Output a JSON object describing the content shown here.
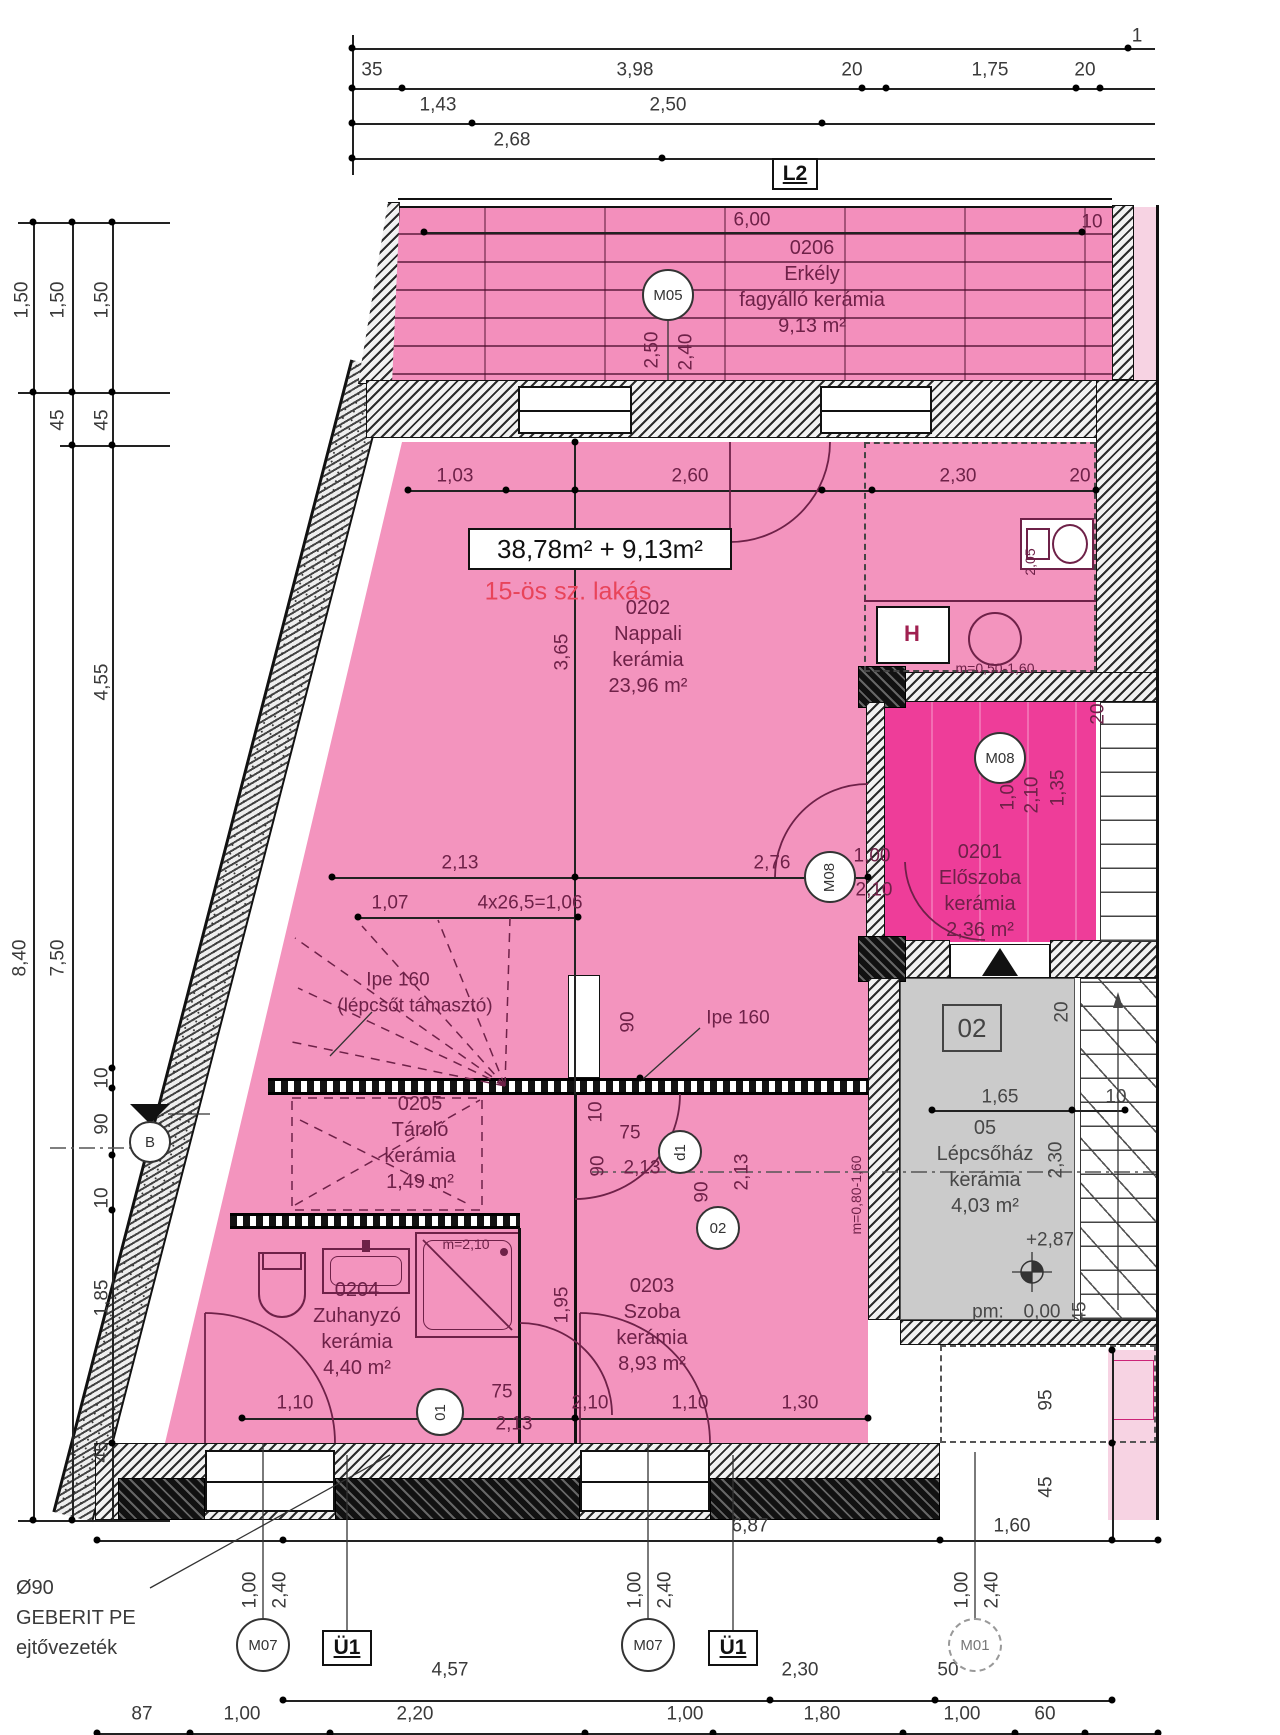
{
  "plan_meta": {
    "unit_area_label": "38,78m² + 9,13m²",
    "unit_name": "15-ös sz. lakás",
    "colors": {
      "apartment_pink": "#F394BE",
      "entry_magenta": "#EE3D99",
      "stairwell_grey": "#CBCBCB",
      "adjacent_pink": "#F7D3E3",
      "accent_red": "#E8445A",
      "dim_text": "#3A3A3A",
      "interior_text": "#6E2148"
    }
  },
  "rooms": [
    {
      "number": "0206",
      "name": "Erkély",
      "material": "fagyálló kerámia",
      "area": "9,13 m²",
      "x": 812,
      "y": 248,
      "cls": "pink"
    },
    {
      "number": "0202",
      "name": "Nappali",
      "material": "kerámia",
      "area": "23,96 m²",
      "x": 648,
      "y": 608,
      "cls": "pink"
    },
    {
      "number": "0201",
      "name": "Előszoba",
      "material": "kerámia",
      "area": "2,36 m²",
      "x": 980,
      "y": 852,
      "cls": "pink"
    },
    {
      "number": "0205",
      "name": "Tároló",
      "material": "kerámia",
      "area": "1,49 m²",
      "x": 420,
      "y": 1104,
      "cls": "pink"
    },
    {
      "number": "0203",
      "name": "Szoba",
      "material": "kerámia",
      "area": "8,93 m²",
      "x": 652,
      "y": 1286,
      "cls": "pink"
    },
    {
      "number": "0204",
      "name": "Zuhanyzó",
      "material": "kerámia",
      "area": "4,40 m²",
      "x": 357,
      "y": 1290,
      "cls": "pink"
    },
    {
      "number": "05",
      "name": "Lépcsőház",
      "material": "kerámia",
      "area": "4,03 m²",
      "x": 985,
      "y": 1128,
      "cls": "grey"
    }
  ],
  "boxes": [
    {
      "t": "L2",
      "x": 772,
      "y": 158,
      "w": 46,
      "h": 32,
      "cls": ""
    },
    {
      "t": "Ü1",
      "x": 322,
      "y": 1630,
      "w": 50,
      "h": 36,
      "cls": ""
    },
    {
      "t": "Ü1",
      "x": 708,
      "y": 1630,
      "w": 50,
      "h": 36,
      "cls": ""
    },
    {
      "t": "02",
      "x": 942,
      "y": 1004,
      "w": 60,
      "h": 48,
      "cls": "ref2"
    },
    {
      "t": "38,78m² + 9,13m²",
      "x": 468,
      "y": 528,
      "w": 264,
      "h": 42,
      "cls": "area"
    }
  ],
  "markers": [
    {
      "t": "M05",
      "x": 668,
      "y": 295,
      "r": 26
    },
    {
      "t": "M08",
      "x": 830,
      "y": 877,
      "r": 26,
      "rot": 1
    },
    {
      "t": "M08",
      "x": 1000,
      "y": 758,
      "r": 26
    },
    {
      "t": "01",
      "x": 440,
      "y": 1412,
      "r": 24,
      "rot": 1
    },
    {
      "t": "02",
      "x": 718,
      "y": 1228,
      "r": 22
    },
    {
      "t": "d1",
      "x": 680,
      "y": 1152,
      "r": 22,
      "rot": 1
    },
    {
      "t": "M07",
      "x": 263,
      "y": 1645,
      "r": 27
    },
    {
      "t": "M07",
      "x": 648,
      "y": 1645,
      "r": 27
    },
    {
      "t": "M01",
      "x": 975,
      "y": 1645,
      "r": 27,
      "dash": 1
    },
    {
      "t": "B",
      "x": 150,
      "y": 1142,
      "r": 21
    }
  ],
  "labels": [
    {
      "t": "1",
      "x": 1137,
      "y": 36,
      "c": "d"
    },
    {
      "t": "35",
      "x": 372,
      "y": 70,
      "c": "d"
    },
    {
      "t": "3,98",
      "x": 635,
      "y": 70,
      "c": "d"
    },
    {
      "t": "20",
      "x": 852,
      "y": 70,
      "c": "d"
    },
    {
      "t": "1,75",
      "x": 990,
      "y": 70,
      "c": "d"
    },
    {
      "t": "20",
      "x": 1085,
      "y": 70,
      "c": "d"
    },
    {
      "t": "1,43",
      "x": 438,
      "y": 105,
      "c": "d"
    },
    {
      "t": "2,50",
      "x": 668,
      "y": 105,
      "c": "d"
    },
    {
      "t": "2,68",
      "x": 512,
      "y": 140,
      "c": "d"
    },
    {
      "t": "6,00",
      "x": 752,
      "y": 220,
      "c": "p"
    },
    {
      "t": "10",
      "x": 1092,
      "y": 222,
      "c": "p"
    },
    {
      "t": "2,50",
      "x": 652,
      "y": 350,
      "c": "p",
      "r": 1
    },
    {
      "t": "2,40",
      "x": 686,
      "y": 352,
      "c": "p",
      "r": 1
    },
    {
      "t": "1,03",
      "x": 455,
      "y": 476,
      "c": "p"
    },
    {
      "t": "2,60",
      "x": 690,
      "y": 476,
      "c": "p"
    },
    {
      "t": "2,30",
      "x": 958,
      "y": 476,
      "c": "p"
    },
    {
      "t": "20",
      "x": 1080,
      "y": 476,
      "c": "p"
    },
    {
      "t": "3,65",
      "x": 562,
      "y": 652,
      "c": "p",
      "r": 1
    },
    {
      "t": "H",
      "x": 912,
      "y": 634,
      "c": "ph"
    },
    {
      "t": "m=0,50-1,60",
      "x": 995,
      "y": 668,
      "c": "s"
    },
    {
      "t": "2,05",
      "x": 1030,
      "y": 562,
      "c": "s",
      "r": 1
    },
    {
      "t": "2,13",
      "x": 460,
      "y": 863,
      "c": "p"
    },
    {
      "t": "2,76",
      "x": 772,
      "y": 863,
      "c": "p"
    },
    {
      "t": "1,00",
      "x": 872,
      "y": 856,
      "c": "p"
    },
    {
      "t": "2,10",
      "x": 874,
      "y": 890,
      "c": "p"
    },
    {
      "t": "1,07",
      "x": 390,
      "y": 903,
      "c": "p"
    },
    {
      "t": "4x26,5=1,06",
      "x": 530,
      "y": 903,
      "c": "p"
    },
    {
      "t": "Ipe 160",
      "x": 398,
      "y": 980,
      "c": "p"
    },
    {
      "t": "(lépcsőt támasztó)",
      "x": 415,
      "y": 1006,
      "c": "p"
    },
    {
      "t": "Ipe 160",
      "x": 738,
      "y": 1018,
      "c": "p"
    },
    {
      "t": "90",
      "x": 628,
      "y": 1022,
      "c": "p",
      "r": 1
    },
    {
      "t": "10",
      "x": 596,
      "y": 1112,
      "c": "p",
      "r": 1
    },
    {
      "t": "75",
      "x": 630,
      "y": 1133,
      "c": "p"
    },
    {
      "t": "90",
      "x": 598,
      "y": 1166,
      "c": "p",
      "r": 1
    },
    {
      "t": "2,13",
      "x": 642,
      "y": 1168,
      "c": "p"
    },
    {
      "t": "90",
      "x": 702,
      "y": 1192,
      "c": "p",
      "r": 1
    },
    {
      "t": "2,13",
      "x": 742,
      "y": 1172,
      "c": "p",
      "r": 1
    },
    {
      "t": "1,95",
      "x": 562,
      "y": 1305,
      "c": "p",
      "r": 1
    },
    {
      "t": "m=0,80-1,60",
      "x": 856,
      "y": 1195,
      "c": "s",
      "r": 1
    },
    {
      "t": "m=2,10",
      "x": 466,
      "y": 1244,
      "c": "s"
    },
    {
      "t": "1,10",
      "x": 295,
      "y": 1403,
      "c": "p"
    },
    {
      "t": "75",
      "x": 502,
      "y": 1392,
      "c": "p"
    },
    {
      "t": "2,13",
      "x": 514,
      "y": 1424,
      "c": "p"
    },
    {
      "t": "2,10",
      "x": 590,
      "y": 1403,
      "c": "p"
    },
    {
      "t": "1,10",
      "x": 690,
      "y": 1403,
      "c": "p"
    },
    {
      "t": "1,30",
      "x": 800,
      "y": 1403,
      "c": "p"
    },
    {
      "t": "1,00",
      "x": 1008,
      "y": 792,
      "c": "p",
      "r": 1
    },
    {
      "t": "2,10",
      "x": 1032,
      "y": 795,
      "c": "p",
      "r": 1
    },
    {
      "t": "1,35",
      "x": 1058,
      "y": 788,
      "c": "p",
      "r": 1
    },
    {
      "t": "20",
      "x": 1098,
      "y": 714,
      "c": "p",
      "r": 1
    },
    {
      "t": "20",
      "x": 1062,
      "y": 1012,
      "c": "g",
      "r": 1
    },
    {
      "t": "1,65",
      "x": 1000,
      "y": 1097,
      "c": "g"
    },
    {
      "t": "10",
      "x": 1116,
      "y": 1097,
      "c": "g"
    },
    {
      "t": "2,30",
      "x": 1056,
      "y": 1160,
      "c": "g",
      "r": 1
    },
    {
      "t": "+2,87",
      "x": 1050,
      "y": 1240,
      "c": "g"
    },
    {
      "t": "pm:",
      "x": 988,
      "y": 1312,
      "c": "g"
    },
    {
      "t": "0,00",
      "x": 1042,
      "y": 1312,
      "c": "g"
    },
    {
      "t": "45",
      "x": 1080,
      "y": 1312,
      "c": "g",
      "r": 1
    },
    {
      "t": "95",
      "x": 1046,
      "y": 1400,
      "c": "d",
      "r": 1
    },
    {
      "t": "45",
      "x": 1046,
      "y": 1487,
      "c": "d",
      "r": 1
    },
    {
      "t": "6,87",
      "x": 750,
      "y": 1526,
      "c": "d"
    },
    {
      "t": "1,60",
      "x": 1012,
      "y": 1526,
      "c": "d"
    },
    {
      "t": "1,50",
      "x": 22,
      "y": 300,
      "c": "d",
      "r": 1
    },
    {
      "t": "1,50",
      "x": 58,
      "y": 300,
      "c": "d",
      "r": 1
    },
    {
      "t": "1,50",
      "x": 102,
      "y": 300,
      "c": "d",
      "r": 1
    },
    {
      "t": "45",
      "x": 58,
      "y": 420,
      "c": "d",
      "r": 1
    },
    {
      "t": "45",
      "x": 102,
      "y": 420,
      "c": "d",
      "r": 1
    },
    {
      "t": "4,55",
      "x": 102,
      "y": 682,
      "c": "d",
      "r": 1
    },
    {
      "t": "8,40",
      "x": 20,
      "y": 958,
      "c": "d",
      "r": 1
    },
    {
      "t": "7,50",
      "x": 58,
      "y": 958,
      "c": "d",
      "r": 1
    },
    {
      "t": "10",
      "x": 102,
      "y": 1078,
      "c": "d",
      "r": 1
    },
    {
      "t": "90",
      "x": 102,
      "y": 1124,
      "c": "d",
      "r": 1
    },
    {
      "t": "10",
      "x": 102,
      "y": 1198,
      "c": "d",
      "r": 1
    },
    {
      "t": "1,85",
      "x": 102,
      "y": 1298,
      "c": "d",
      "r": 1
    },
    {
      "t": "45",
      "x": 102,
      "y": 1452,
      "c": "d",
      "r": 1
    },
    {
      "t": "1,00",
      "x": 250,
      "y": 1590,
      "c": "d",
      "r": 1
    },
    {
      "t": "2,40",
      "x": 280,
      "y": 1590,
      "c": "d",
      "r": 1
    },
    {
      "t": "1,00",
      "x": 635,
      "y": 1590,
      "c": "d",
      "r": 1
    },
    {
      "t": "2,40",
      "x": 665,
      "y": 1590,
      "c": "d",
      "r": 1
    },
    {
      "t": "1,00",
      "x": 962,
      "y": 1590,
      "c": "d",
      "r": 1
    },
    {
      "t": "2,40",
      "x": 992,
      "y": 1590,
      "c": "d",
      "r": 1
    },
    {
      "t": "4,57",
      "x": 450,
      "y": 1670,
      "c": "d"
    },
    {
      "t": "2,30",
      "x": 800,
      "y": 1670,
      "c": "d"
    },
    {
      "t": "50",
      "x": 948,
      "y": 1670,
      "c": "d"
    },
    {
      "t": "87",
      "x": 142,
      "y": 1714,
      "c": "d"
    },
    {
      "t": "1,00",
      "x": 242,
      "y": 1714,
      "c": "d"
    },
    {
      "t": "2,20",
      "x": 415,
      "y": 1714,
      "c": "d"
    },
    {
      "t": "1,00",
      "x": 685,
      "y": 1714,
      "c": "d"
    },
    {
      "t": "1,80",
      "x": 822,
      "y": 1714,
      "c": "d"
    },
    {
      "t": "1,00",
      "x": 962,
      "y": 1714,
      "c": "d"
    },
    {
      "t": "60",
      "x": 1045,
      "y": 1714,
      "c": "d"
    },
    {
      "t": "Ø90",
      "x": 16,
      "y": 1588,
      "c": "dl"
    },
    {
      "t": "GEBERIT PE",
      "x": 16,
      "y": 1618,
      "c": "dl"
    },
    {
      "t": "ejtővezeték",
      "x": 16,
      "y": 1648,
      "c": "dl"
    },
    {
      "t": "15-ös sz. lakás",
      "x": 568,
      "y": 592,
      "c": "r"
    }
  ],
  "dots": [
    [
      352,
      48
    ],
    [
      1128,
      48
    ],
    [
      352,
      88
    ],
    [
      402,
      88
    ],
    [
      862,
      88
    ],
    [
      886,
      88
    ],
    [
      1076,
      88
    ],
    [
      1100,
      88
    ],
    [
      352,
      123
    ],
    [
      472,
      123
    ],
    [
      822,
      123
    ],
    [
      352,
      158
    ],
    [
      662,
      158
    ],
    [
      424,
      232
    ],
    [
      1082,
      232
    ],
    [
      408,
      490
    ],
    [
      506,
      490
    ],
    [
      575,
      490
    ],
    [
      822,
      490
    ],
    [
      872,
      490
    ],
    [
      1096,
      490
    ],
    [
      332,
      877
    ],
    [
      575,
      877
    ],
    [
      868,
      877
    ],
    [
      358,
      917
    ],
    [
      578,
      917
    ],
    [
      932,
      1110
    ],
    [
      1072,
      1110
    ],
    [
      1125,
      1110
    ],
    [
      242,
      1418
    ],
    [
      575,
      1418
    ],
    [
      868,
      1418
    ],
    [
      97,
      1540
    ],
    [
      283,
      1540
    ],
    [
      940,
      1540
    ],
    [
      1158,
      1540
    ],
    [
      283,
      1700
    ],
    [
      770,
      1700
    ],
    [
      935,
      1700
    ],
    [
      1112,
      1700
    ],
    [
      97,
      1733
    ],
    [
      190,
      1733
    ],
    [
      330,
      1733
    ],
    [
      585,
      1733
    ],
    [
      713,
      1733
    ],
    [
      903,
      1733
    ],
    [
      1015,
      1733
    ],
    [
      1085,
      1733
    ],
    [
      1158,
      1733
    ],
    [
      33,
      222
    ],
    [
      72,
      222
    ],
    [
      112,
      222
    ],
    [
      33,
      392
    ],
    [
      72,
      392
    ],
    [
      112,
      392
    ],
    [
      72,
      445
    ],
    [
      112,
      445
    ],
    [
      112,
      1068
    ],
    [
      112,
      1088
    ],
    [
      112,
      1155
    ],
    [
      112,
      1210
    ],
    [
      112,
      1443
    ],
    [
      72,
      1520
    ],
    [
      33,
      1520
    ],
    [
      1112,
      1350
    ],
    [
      1112,
      1443
    ],
    [
      1112,
      1540
    ],
    [
      640,
      1078
    ],
    [
      575,
      442
    ]
  ]
}
